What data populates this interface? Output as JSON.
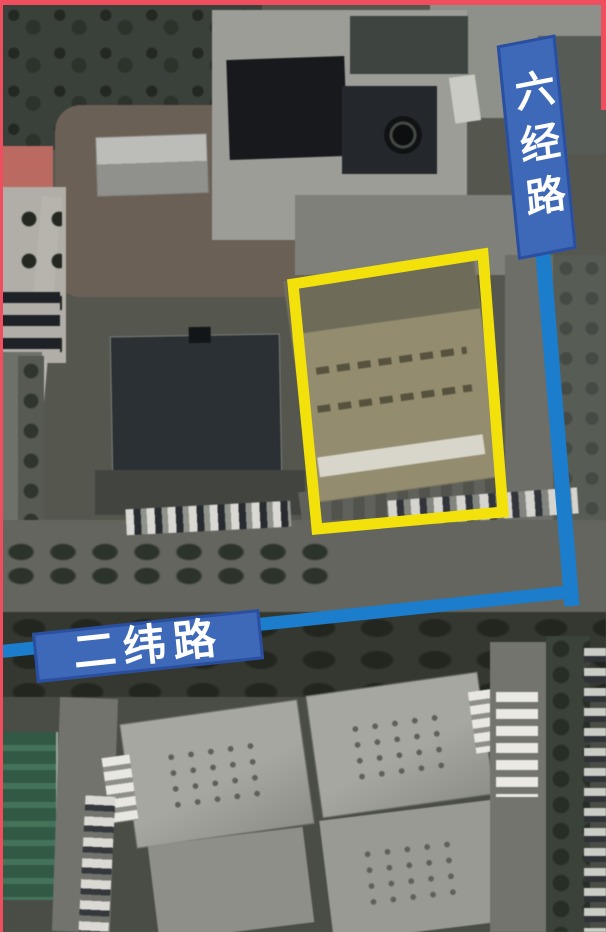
{
  "map": {
    "type": "satellite-aerial",
    "road_labels": [
      {
        "id": "liujing-road",
        "text": "六经路",
        "orientation": "vertical"
      },
      {
        "id": "erwei-road",
        "text": "二纬路",
        "orientation": "horizontal"
      }
    ],
    "annotations": {
      "highlight_box_color": "#f2e10a",
      "road_line_color": "#1b7dcb",
      "banner_fill": "#3e68b8",
      "banner_border": "#2a4fa0",
      "banner_text_color": "#ffffff",
      "frame_color": "#ee4e5e"
    }
  }
}
